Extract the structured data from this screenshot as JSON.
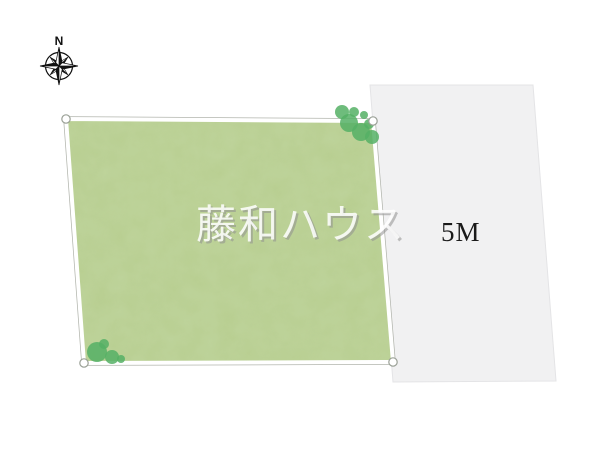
{
  "compass": {
    "north_label": "N"
  },
  "road": {
    "width_label": "5M"
  },
  "watermark": {
    "text": "藤和ハウス"
  },
  "colors": {
    "plot_fill": "#b9cf92",
    "plot_border_white": "#ffffff",
    "plot_outline_gray": "#b2b5ad",
    "tree_fill": "#55b065",
    "road_fill": "#f1f1f2",
    "road_border": "#e4e4e6",
    "road_label_color": "#1a1a1a",
    "compass_color": "#111111"
  }
}
